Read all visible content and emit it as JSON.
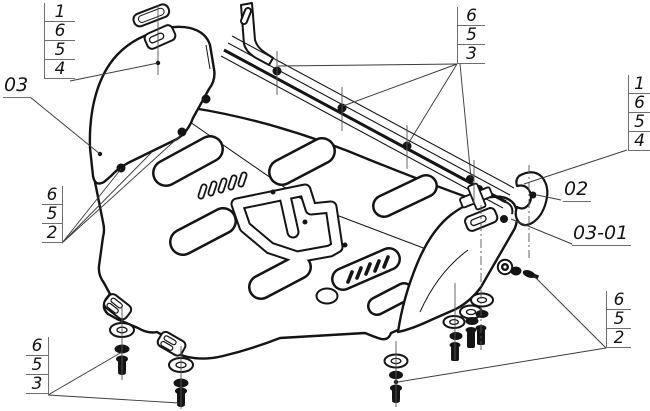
{
  "colors": {
    "background": "#ffffff",
    "ink": "#141414",
    "thin_line": "#3c3c3c",
    "table_line": "#6e6e6e"
  },
  "callouts": {
    "top_left": {
      "items": [
        "1",
        "6",
        "5",
        "4"
      ]
    },
    "top_right": {
      "items": [
        "6",
        "5",
        "3"
      ]
    },
    "right": {
      "items": [
        "1",
        "6",
        "5",
        "4"
      ]
    },
    "mid_left": {
      "items": [
        "6",
        "5",
        "2"
      ]
    },
    "bottom_left": {
      "items": [
        "6",
        "5",
        "3"
      ]
    },
    "bottom_right": {
      "items": [
        "6",
        "5",
        "2"
      ]
    }
  },
  "part_labels": {
    "left": "03",
    "right_upper": "02",
    "right_lower": "03-01"
  }
}
